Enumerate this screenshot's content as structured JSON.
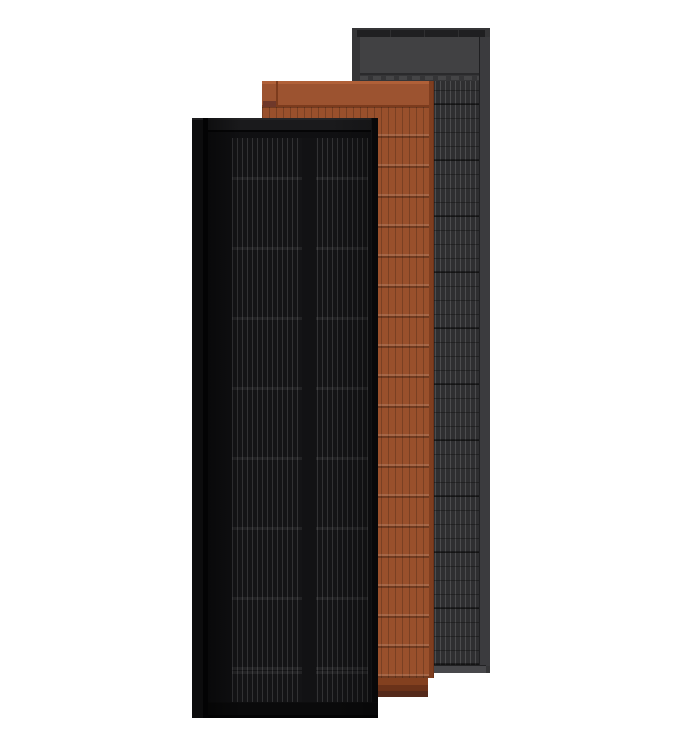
{
  "scene": {
    "description": "Product render of three overlapping tall solar roof panels on a white background",
    "panels": [
      {
        "name": "black solar panel (front)",
        "position": "front",
        "base_color": "#111113"
      },
      {
        "name": "terracotta solar roof tile (middle)",
        "position": "middle",
        "base_color": "#99502c"
      },
      {
        "name": "slate gray solar roof tile (back)",
        "position": "back",
        "base_color": "#313133"
      }
    ]
  },
  "colors": {
    "canvas-bg": "#ffffff",
    "gray-frame": "#353537",
    "gray-top-bar": "#1f1f21",
    "gray-header": "#414143",
    "gray-header-seam": "#2a2a2c",
    "gray-cells-base": "#2f2f31",
    "gray-cell-line": "#ffffff24",
    "gray-row-thin": "#0000004d",
    "gray-row-thick": "#00000066",
    "gray-right-rail": "#3b3b3e",
    "gray-bottom-strip": "#48484b",
    "terra-band-highlight": "#b06038",
    "terra-band": "#9c5330",
    "terra-seam": "#7c3b1d",
    "terra-cells-base": "#99502c",
    "terra-cell-line": "#00000033",
    "terra-row-dark": "#00000042",
    "terra-row-light": "#ffffff21",
    "terra-right-edge": "#7f3e20",
    "terra-lip-1": "#83401f",
    "terra-lip-2": "#6b3219",
    "terra-lip-3": "#552a1b",
    "terra-tab": "#6f382a",
    "black-rail": "#0c0c0d",
    "black-groove": "#030304",
    "black-body": "#101012",
    "black-lip": "#1a1a1c",
    "black-cells-base": "#141416",
    "black-cell-line": "#ffffff21",
    "black-row-band": "#ffffff10",
    "black-right-rail": "#0a0a0b",
    "black-bottom": "#0a0a0b",
    "black-gap": "#121214"
  }
}
